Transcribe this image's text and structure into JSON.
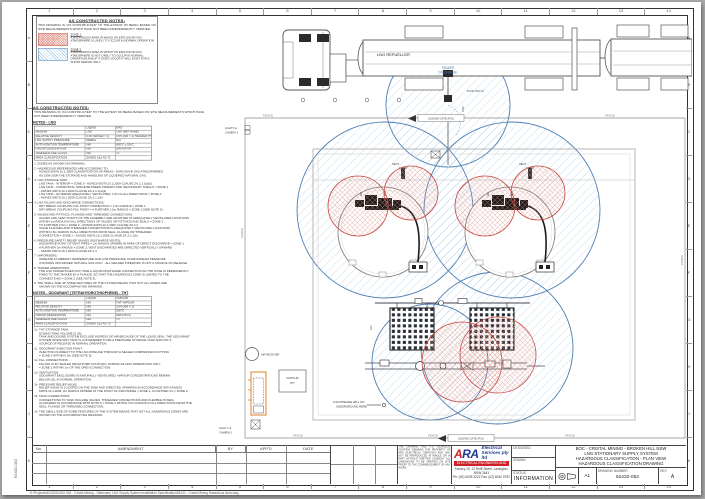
{
  "page": {
    "bg": "#b9b9b9",
    "paper": "#ffffff"
  },
  "colors": {
    "zone1": "#c4453c",
    "zone2": "#4d7fb5",
    "hatch_red": "#e0948a",
    "hatch_blue": "#9cc4e0",
    "cabinet_orange": "#e08020",
    "line": "#555555"
  },
  "border": {
    "columns": [
      "1",
      "2",
      "3",
      "4",
      "5",
      "6",
      "7",
      "8",
      "9",
      "10",
      "11",
      "12",
      "13",
      "14"
    ],
    "rows": [
      "A",
      "B",
      "C",
      "D",
      "E",
      "F",
      "G",
      "H",
      "J",
      "K"
    ]
  },
  "notes_panel": {
    "heading": "AS CONSTRUCTED NOTES:",
    "body": "THIS DRAWING IS \"AS CONSTRUCTED\" TO THE EXTENT OF BEING BASED ON SITE MEASUREMENTS WHICH HAVE NOT BEEN INDEPENDENTLY VERIFIED.",
    "zone1_title": "ZONE 1",
    "zone1_desc": "A HAZARDOUS AREA IN WHICH AN EXPLOSIVE GAS ATMOSPHERE IS LIKELY TO OCCUR IN NORMAL OPERATION.",
    "zone2_title": "ZONE 2",
    "zone2_desc": "A HAZARDOUS AREA IN WHICH AN EXPLOSIVE GAS ATMOSPHERE IS NOT LIKELY TO OCCUR IN NORMAL OPERATION AND IF IT DOES OCCUR IT WILL EXIST FOR A SHORT PERIOD ONLY."
  },
  "notes_main": {
    "heading": "AS CONSTRUCTED NOTES:",
    "body": "THIS DRAWING IS \"AS CONSTRUCTED\" TO THE EXTENT OF BEING BASED ON SITE MEASUREMENTS WHICH HAVE NOT BEEN INDEPENDENTLY VERIFIED.",
    "lng_heading": "NOTES - LNG",
    "lng_table": [
      [
        "",
        "LIQUID",
        "GAS"
      ],
      [
        "MEDIUM",
        "LNG",
        "LNG (METHANE)"
      ],
      [
        "RELATIVE DENSITY",
        "0.45 (WATER = 1)",
        "0.55 (AIR = 1) HEAVIER THAN AIR WHEN COLD"
      ],
      [
        "LNG SUPPLY PRESSURE",
        "600kPa",
        "N/A"
      ],
      [
        "AUTO-IGNITION TEMPERATURE",
        "N/A",
        "600°C ± 50°C"
      ],
      [
        "GROUP DESIGNATION",
        "N/A",
        "GROUP IIA"
      ],
      [
        "TEMPERATURE CLASS",
        "N/A",
        "T1"
      ],
      [
        "AREA CLASSIFICATION",
        "ZONES 1&2 AS T1",
        ""
      ]
    ],
    "notes_lng": [
      "1. ZONES AS SHOWN ON DRAWING.",
      "2. HAZARDOUS REFERENCES ARE ACCORDING TO:\nAS/NZS 60079.10.1:2009 CLASSIFICATION OF AREAS - EXPLOSIVE GAS ATMOSPHERES\nAS 1596-2008 THE STORAGE AND HANDLING OF LIQUEFIED NATURAL GAS.",
      "3. LNG STORAGE TANK:\nLNG TANK - INTERIOR = ZONE 0 - AS/NZS 60079.10.1:2009 CLAUSE ZA.2.1.1(a)(i)\nLNG TANK - HORIZONTAL SPACE BETWEEN PRIMARY AND SECONDARY SHELLS = ZONE 1\n- AS/NZS 60079.10.1:2009 CLAUSE ZA.2.1.1(a)(ii)\nLNG TANK - EXTERIOR ADEQUATELY VENTILATED: 1.5m IN ALL DIRECTIONS = ZONE 2\n- AS/NZS 60079.10.1:2009 CLAUSE ZA.2.1.1(b)",
      "4. LNG FILLING AND DISCHARGE CONNECTIONS:\nDRY BREAK COUPLING FILL POINT CONNECTION = 1.5m RADIUS = ZONE 1\nDRY BREAK COUPLING FILL POINT = A FURTHER 1.5m RADIUS = ZONE 2 (SEE NOTE 5).",
      "5. VALVES AND FITTINGS, FLANGED AND THREADED CONNECTIONS:\nVALVES AND VENT POINTS OF THE ASSEMBLY ARE MOUNTED AT ADEQUATELY VENTILATED LOCATIONS\nWITHIN 1m RADIUS IN ALL DIRECTIONS OF VALVES OR FITTINGS AND SEALS = ZONE 1\nTO FURTHER 0.5m = ZONE 2 - AS/NZS 60079.10.1:2009 CLAUSE ZA.2.2\nVALVE FLANGES AND THREADED CONNECTIONS IN ADEQUATELY VENTILATED LOCATIONS\nWITHIN 0.5m RADIUS IN ALL DIRECTIONS FROM SEAL, FLANGE OR THREADED\nCONNECTION = ZONE 2 - AS/NZS 60079.10.1:2009 CLAUSE ZA.2.2.1(b)",
      "6. PRESSURE SAFETY RELIEF VALVES (DISCHARGE VENTS):\nDISCHARGE POINT OF VENT PIPES = 2m RADIUS SPHERE IN AREA OF DIRECT DISCHARGE = ZONE 1\nA FURTHER 2m RADIUS = ZONE 2; VENT DISCHARGES ARE DIRECTED VERTICALLY UPWARD\n- AS/NZS 60079.10.1:2009 CLAUSE ZA.2.3",
      "7. VAPORISERS:\nOPERATE AT AMBIENT TEMPERATURE AND LOW PRESSURE; DOWNSTREAM PIPEWORK\nCONTAINS ODOURISED NATURAL GAS ONLY - ALL WELDED PIPEWORK IS NOT A SOURCE OF RELEASE.",
      "8. TANKER OPERATIONS:\nTHE LNG TANKER DOES NOT HAVE A LIQUID DISCHARGE CONNECTION AS THE HOSE IS PERMANENTLY\nFIXED TO THE TANKER BY A FLANGE, SO THAT THE HAZARDOUS ZONE IS LIMITED TO THE\nCONNECTIONS = ZONE 2 (SEE NOTE 5).",
      "9. THE SMALL SIZE OF SOME FEATURES OF THE SYSTEM MEANS THAT NOT ALL ZONES ARE\nSHOWN ON THE ACCOMPANYING DRAWING."
    ],
    "odourant_heading": "NOTES - ODOURANT (TETRAHYDROTHIOPHENE) - THT",
    "odourant_table": [
      [
        "",
        "LIQUID",
        "VAPOUR"
      ],
      [
        "MEDIUM",
        "N/A",
        "THT VAPOUR"
      ],
      [
        "RELATIVE DENSITY",
        "N/A",
        "3.04 (AIR = 1)"
      ],
      [
        "AUTO-IGNITION TEMPERATURE",
        "N/A",
        "200°C"
      ],
      [
        "GROUP DESIGNATION",
        "N/A",
        "GROUP IIA"
      ],
      [
        "TEMPERATURE CLASS",
        "N/A",
        "T3"
      ],
      [
        "AREA CLASSIFICATION",
        "ZONES 1&2 AS T3",
        ""
      ]
    ],
    "notes_odourant": [
      "10. THT STORAGE TANK:\nDOSING TANK VOLUME IS 25L.\nTANK AND DOSING SYSTEM EXCLUDE INGRESS OF AIR BECAUSE OF THE LIQUID SEAL; THE ODOURANT\nSYSTEM INVENTORY TANK IS CONSIDERED TO BE A PRESSURE STORAGE TANK AND NOT A\nSOURCE OF RELEASE IN NORMAL OPERATION.",
      "11. ODOURANT INJECTION POINT:\nINJECTION IS DIRECT TO THE LNG PIPELINE THROUGH A SEALED COMPRESSION FITTING\n= ZONE 2 WITHIN 0.5m (SEE NOTE 5).",
      "12. FILL CONNECTIONS:\nFILLING IS BY SEALED DRUM PUMP COUPLING; DURING FILLING OPERATIONS ONLY\n= ZONE 1 WITHIN 1m OF THE OPEN CONNECTION.",
      "13. VENTILATION:\nODOURANT ENCLOSURE IS NATURALLY VENTILATED; VAPOUR CONCENTRATIONS REMAIN\nBELOW LEL IN NORMAL OPERATION.",
      "14. PRESSURE RELIEF VALVE:\nRELIEF VALVE IS LOCATED ON THE TANK AND DIRECTED UPWARDS IN ACCORDANCE WITH AS/NZS\n60079.10.1:2009; 2m RADIUS SPHERE AT THE POINT OF DISCHARGE = ZONE 1, A FURTHER 2m = ZONE 2.",
      "15. TANK CONNECTIONS:\nCONNECTIONS TO TANK INCLUDE VALVES, THREADED CONNECTIONS AND FLEXIBLE HOSES,\nCLASSIFIED IN ACCORDANCE WITH NOTE 5 = ZONE 2 WITHIN 0.5m RADIUS IN ALL DIRECTIONS FROM THE\nSEAL, FLANGE OR THREADED CONNECTION.",
      "16. THE SMALL SIZE OF SOME FEATURES OF THE SYSTEM MEANS THAT NOT ALL HAZARDOUS ZONES ARE\nSHOWN ON THE ACCOMPANYING DRAWING."
    ]
  },
  "drawing": {
    "truck_label": "LNG REFUELLER",
    "tanker_discharge_l1": "TANKER",
    "tanker_discharge_l2": "DISCHARGE",
    "bund_depth": "BUND DEPTH",
    "fence": "FENCE",
    "sliding_gate": "SLIDING GATE (P/G)",
    "vent": "VENT",
    "dim_3430": "3430",
    "dim_620": "620",
    "lights_l1": "LIGHTS &",
    "lights_l2": "CAMERA 1",
    "light_bl_l1": "LIGHT 1 &",
    "light_bl_l2": "CAMERA 1",
    "air_receiver": "AIR RECEIVER",
    "vapour_pit_l1": "VAPOUR",
    "vapour_pit_l2": "PIT",
    "pipeline_l1": "LNG PIPELINE WILL GO",
    "pipeline_l2": "UNDERGROUND HERE"
  },
  "titleblock": {
    "amend_headers": [
      "No.",
      "AMENDMENT",
      "BY",
      "APP'D",
      "DATE"
    ],
    "disclaimer": "THE DRAWING AND ITS TECHNICAL CONTENT REMAINS THE PROPERTY OF ARA ELECTRICAL SERVICES AND MAY NOT BE REPRODUCED IN WHOLE OR IN PART WITHOUT WRITTEN CONSENT. ALL DIMENSIONS TO BE VERIFIED ON SITE PRIOR TO THE COMMENCEMENT OF ANY WORK.",
    "brand_a": "A",
    "brand_ra": "RA",
    "brand_italic1": "Electrical",
    "brand_italic2": "Services pty ltd",
    "brand_sub": "ELECTRICAL ENGINEERS AND CONSULTANTS",
    "address1": "Factory 10, 12 Reiff Street, Lavington, NSW 2641",
    "address2": "Ph: (02) 6025 3222   Fax: (02) 6040 9792",
    "designed_label": "DESIGNED",
    "drawn_label": "DRAWN",
    "status_label": "STATUS",
    "status_value": "INFORMATION",
    "title_line1": "BOC - CRISTAL MINING - BROKEN HILL NSW",
    "title_line2": "LNG STATIONARY SUPPLY SYSTEM",
    "title_line3": "HAZARDOUS CLASSIFICATION - PLAN VIEW",
    "title_line4": "HAZARDOUS CLASSIFICATION DRAWING",
    "sheet_size": "A1",
    "drawing_number_label": "DRAWING NUMBER",
    "drawing_number": "62432-052",
    "rev_label": "REV",
    "rev_value": "A"
  },
  "footer": {
    "path": "K:\\Projects\\62432\\62432-052 - Cristal Mining - Stationary LNG Supply System Installation Specification\\62432 - Cristal Mining Hazardous Area.dwg",
    "side_text": "62432-052"
  }
}
